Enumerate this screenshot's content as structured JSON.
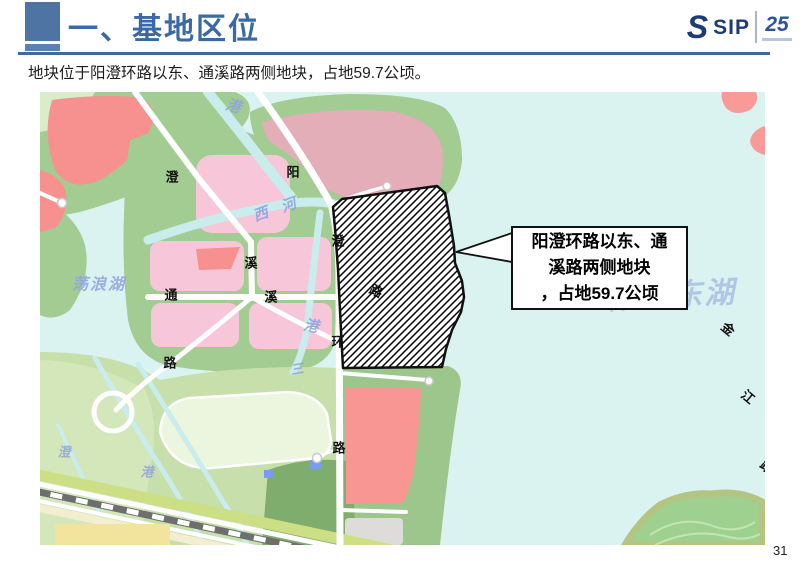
{
  "slide": {
    "title": "一、基地区位",
    "subtitle": "地块位于阳澄环路以东、通溪路两侧地块，占地59.7公顷。",
    "page_number": "31",
    "logo": {
      "s_mark": "S",
      "brand": "SIP",
      "badge": "25"
    },
    "accent_color": "#3f6ba6"
  },
  "callout": {
    "line1": "阳澄环路以东、通",
    "line2": "溪路两侧地块",
    "line3": "，占地59.7公顷"
  },
  "map": {
    "colors": {
      "water": "#daf3f1",
      "greenbelt": "#a3cc92",
      "park": "#c6dfab",
      "dark_green": "#7fad6e",
      "residential_pink": "#f8c6d9",
      "red_block": "#f69190",
      "rose_block": "#e3aeb8",
      "yellow_block": "#f2e39d",
      "site_outline": "#111111"
    },
    "road_labels": [
      {
        "t": "澄",
        "x": 172,
        "y": 177
      },
      {
        "t": "阳",
        "x": 293,
        "y": 172
      },
      {
        "t": "溪",
        "x": 251,
        "y": 263
      },
      {
        "t": "通",
        "x": 171,
        "y": 295
      },
      {
        "t": "溪",
        "x": 271,
        "y": 297
      },
      {
        "t": "路",
        "x": 170,
        "y": 363
      },
      {
        "t": "澄",
        "x": 338,
        "y": 241
      },
      {
        "t": "环",
        "x": 338,
        "y": 342
      },
      {
        "t": "路",
        "x": 376,
        "y": 291,
        "rot": 25
      },
      {
        "t": "路",
        "x": 339,
        "y": 448
      },
      {
        "t": "金",
        "x": 728,
        "y": 329,
        "rot": 40
      },
      {
        "t": "江",
        "x": 748,
        "y": 397,
        "rot": 40
      },
      {
        "t": "路",
        "x": 767,
        "y": 467,
        "rot": 40
      }
    ],
    "water_labels": [
      {
        "t": "港",
        "x": 233,
        "y": 107,
        "rot": 15
      },
      {
        "t": "西",
        "x": 261,
        "y": 215,
        "rot": -20
      },
      {
        "t": "河",
        "x": 289,
        "y": 206,
        "rot": -20
      },
      {
        "t": "荡浪湖",
        "x": 99,
        "y": 285,
        "size": 16,
        "spacing": 2
      },
      {
        "t": "港",
        "x": 311,
        "y": 327,
        "rot": 10
      },
      {
        "t": "澄",
        "x": 64,
        "y": 452,
        "size": 13
      },
      {
        "t": "港",
        "x": 147,
        "y": 472,
        "size": 13
      },
      {
        "t": "三",
        "x": 297,
        "y": 369,
        "size": 13,
        "rot": -10
      },
      {
        "t": "阳澄东湖",
        "x": 672,
        "y": 296,
        "size": 30,
        "spacing": 2,
        "rot": -3,
        "opacity": 0.55
      }
    ]
  }
}
